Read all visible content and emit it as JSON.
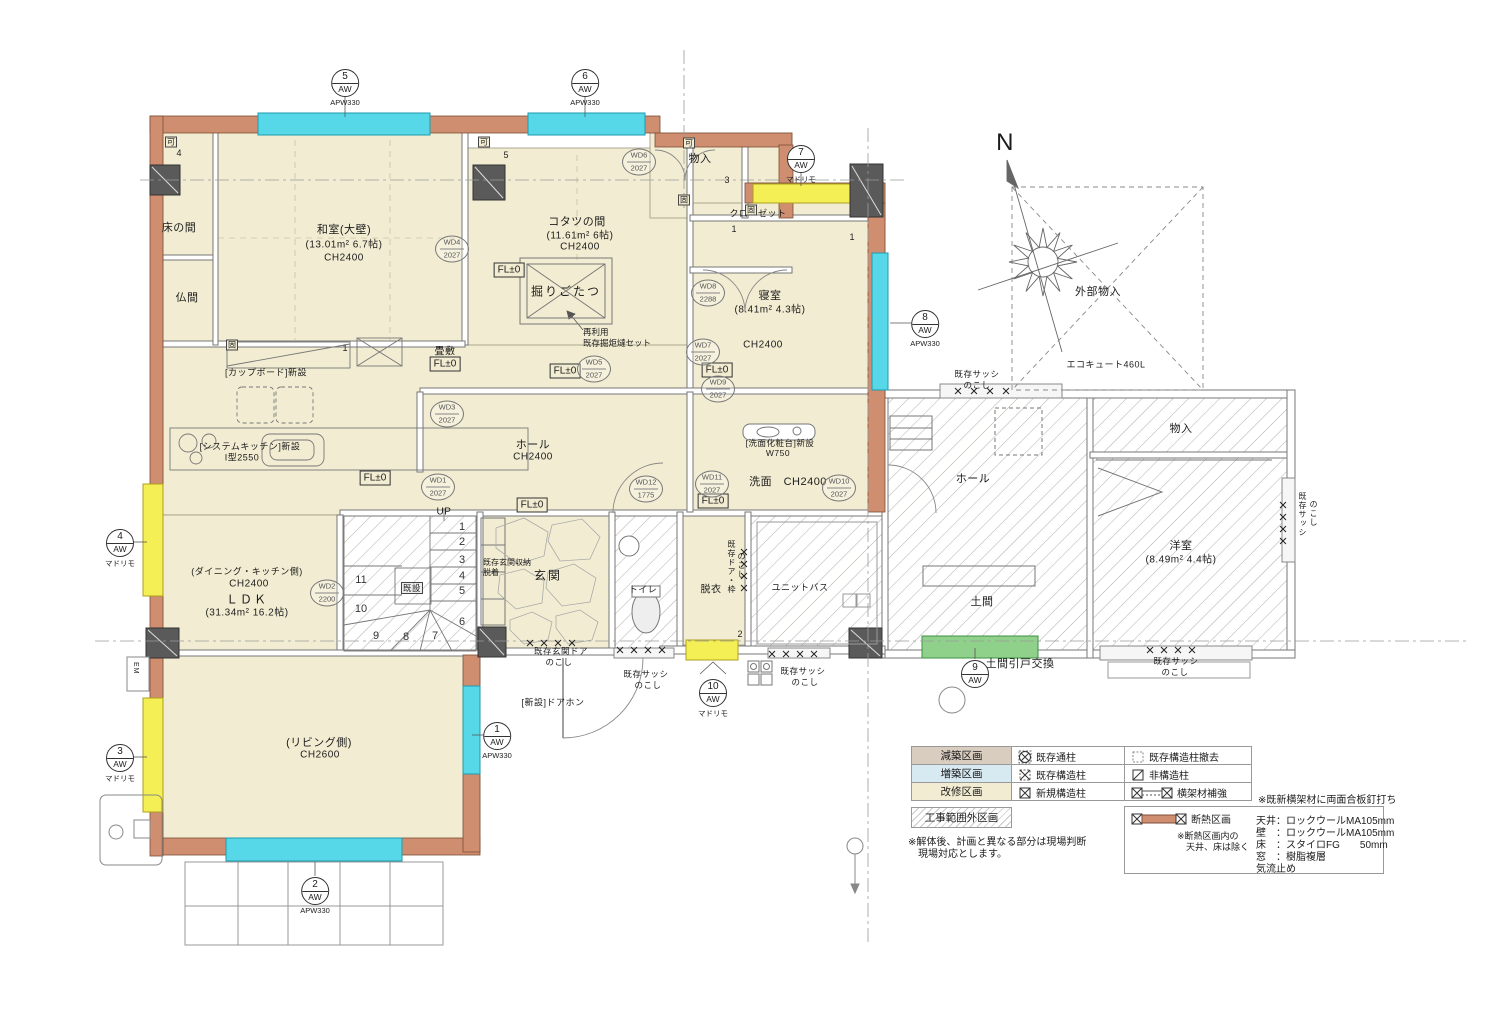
{
  "colors": {
    "renovation_zone": "#f2edd2",
    "addition_zone": "#d7eaf2",
    "reduction_zone": "#d9cdc0",
    "insulation": "#cf8e6f",
    "window_new_apw": "#57d8e8",
    "window_madorimo": "#f4ef55",
    "doma_door_green": "#8fd08a"
  },
  "compass": {
    "north": "N"
  },
  "rooms": {
    "tokonoma": "床の間",
    "butsuma": "仏間",
    "washitsu": {
      "name": "和室(大壁)",
      "area": "(13.01m² 6.7帖)",
      "ch": "CH2400"
    },
    "kotatsu": {
      "name": "コタツの間",
      "area": "(11.61m² 6帖)",
      "ch": "CH2400"
    },
    "horigotatsu": "掘りごたつ",
    "monoire_top": "物入",
    "closet": "クローゼット",
    "shinshitsu": {
      "name": "寝室",
      "area": "(8.41m² 4.3帖)",
      "ch": "CH2400"
    },
    "tatamijiki": "畳敷",
    "ldk": {
      "side": "(ダイニング・キッチン側)",
      "ch": "CH2400",
      "name": "ＬＤＫ",
      "area": "(31.34m² 16.2帖)"
    },
    "living": {
      "side": "(リビング側)",
      "ch": "CH2600"
    },
    "hall": {
      "name": "ホール",
      "ch": "CH2400"
    },
    "genkan": "玄関",
    "toilet": "トイレ",
    "datsui": "脱衣",
    "senmen": "洗面　CH2400",
    "unitbath": "ユニットバス",
    "hall2": "ホール",
    "doma": "土間",
    "monoire_right": "物入",
    "yoshitsu": {
      "name": "洋室",
      "area": "(8.49m² 4.4帖)"
    },
    "gaibu_monoire": "外部物入"
  },
  "annotations": {
    "fl0": "FL±0",
    "up": "UP",
    "stair_core": "既設",
    "cupboard": "[カップボード]新設",
    "kitchen1": "[システムキッチン]新設",
    "kitchen2": "I型2550",
    "vanity1": "[洗面化粧台]新設",
    "vanity2": "W750",
    "horigotatsu_note1": "再利用",
    "horigotatsu_note2": "既存掘炬燵セット",
    "sash1": "既存サッシ",
    "sash2": "のこし",
    "doorwaku1": "既存ドア・枠",
    "doorwaku2": "のこし",
    "genkan_door1": "既存玄関ドア",
    "genkan_door2": "のこし",
    "genkan_storage1": "既存玄関収納",
    "genkan_storage2": "脱着",
    "doorphone": "[新設]ドアホン",
    "doma_door": "土間引戸交換",
    "ecocute": "エコキュート460L",
    "em": "EM"
  },
  "markers": [
    {
      "num": "5",
      "code": "AW",
      "sub": "APW330"
    },
    {
      "num": "6",
      "code": "AW",
      "sub": "APW330"
    },
    {
      "num": "7",
      "code": "AW",
      "sub": "マドリモ"
    },
    {
      "num": "8",
      "code": "AW",
      "sub": "APW330"
    },
    {
      "num": "4",
      "code": "AW",
      "sub": "マドリモ"
    },
    {
      "num": "3",
      "code": "AW",
      "sub": "マドリモ"
    },
    {
      "num": "1",
      "code": "AW",
      "sub": "APW330"
    },
    {
      "num": "2",
      "code": "AW",
      "sub": "APW330"
    },
    {
      "num": "10",
      "code": "AW",
      "sub": "マドリモ"
    },
    {
      "num": "9",
      "code": "AW",
      "sub": ""
    }
  ],
  "wd": [
    {
      "id": "WD4",
      "dim": "2027"
    },
    {
      "id": "WD6",
      "dim": "2027"
    },
    {
      "id": "WD5",
      "dim": "2027"
    },
    {
      "id": "WD8",
      "dim": "2288"
    },
    {
      "id": "WD7",
      "dim": "2027"
    },
    {
      "id": "WD9",
      "dim": "2027"
    },
    {
      "id": "WD3",
      "dim": "2027"
    },
    {
      "id": "WD1",
      "dim": "2027"
    },
    {
      "id": "WD2",
      "dim": "2200"
    },
    {
      "id": "WD12",
      "dim": "1775"
    },
    {
      "id": "WD11",
      "dim": "2027"
    },
    {
      "id": "WD10",
      "dim": "2027"
    }
  ],
  "stairs": {
    "steps": [
      "1",
      "2",
      "3",
      "4",
      "5",
      "6",
      "7",
      "8",
      "9",
      "10",
      "11"
    ]
  },
  "tags": [
    {
      "t": "可"
    },
    {
      "t": "可"
    },
    {
      "t": "可"
    },
    {
      "t": "固"
    },
    {
      "t": "固"
    },
    {
      "t": "固"
    },
    {
      "t": "4"
    },
    {
      "t": "5"
    },
    {
      "t": "3"
    },
    {
      "t": "1"
    },
    {
      "t": "1"
    },
    {
      "t": "1"
    },
    {
      "t": "2"
    }
  ],
  "legend": {
    "rows": [
      {
        "zone": "減築区画",
        "sym1": "既存通柱",
        "sym2": "既存構造柱撤去"
      },
      {
        "zone": "増築区画",
        "sym1": "既存構造柱",
        "sym2": "非構造柱"
      },
      {
        "zone": "改修区画",
        "sym1": "新規構造柱",
        "sym2": "横架材補強"
      },
      {
        "zone": "工事範囲外区画",
        "sym2": "断熱区画"
      }
    ],
    "note_beam": "※既新横架材に両面合板釘打ち",
    "note_insul1": "※断熱区画内の",
    "note_insul2": "天井、床は除く",
    "spec": [
      "天井：ロックウールMA105mm",
      "壁　：ロックウールMA105mm",
      "床　：スタイロFG　　50mm",
      "窓　：樹脂複層",
      "気流止め"
    ],
    "note_site1": "※解体後、計画と異なる部分は現場判断",
    "note_site2": "　現場対応とします。"
  }
}
